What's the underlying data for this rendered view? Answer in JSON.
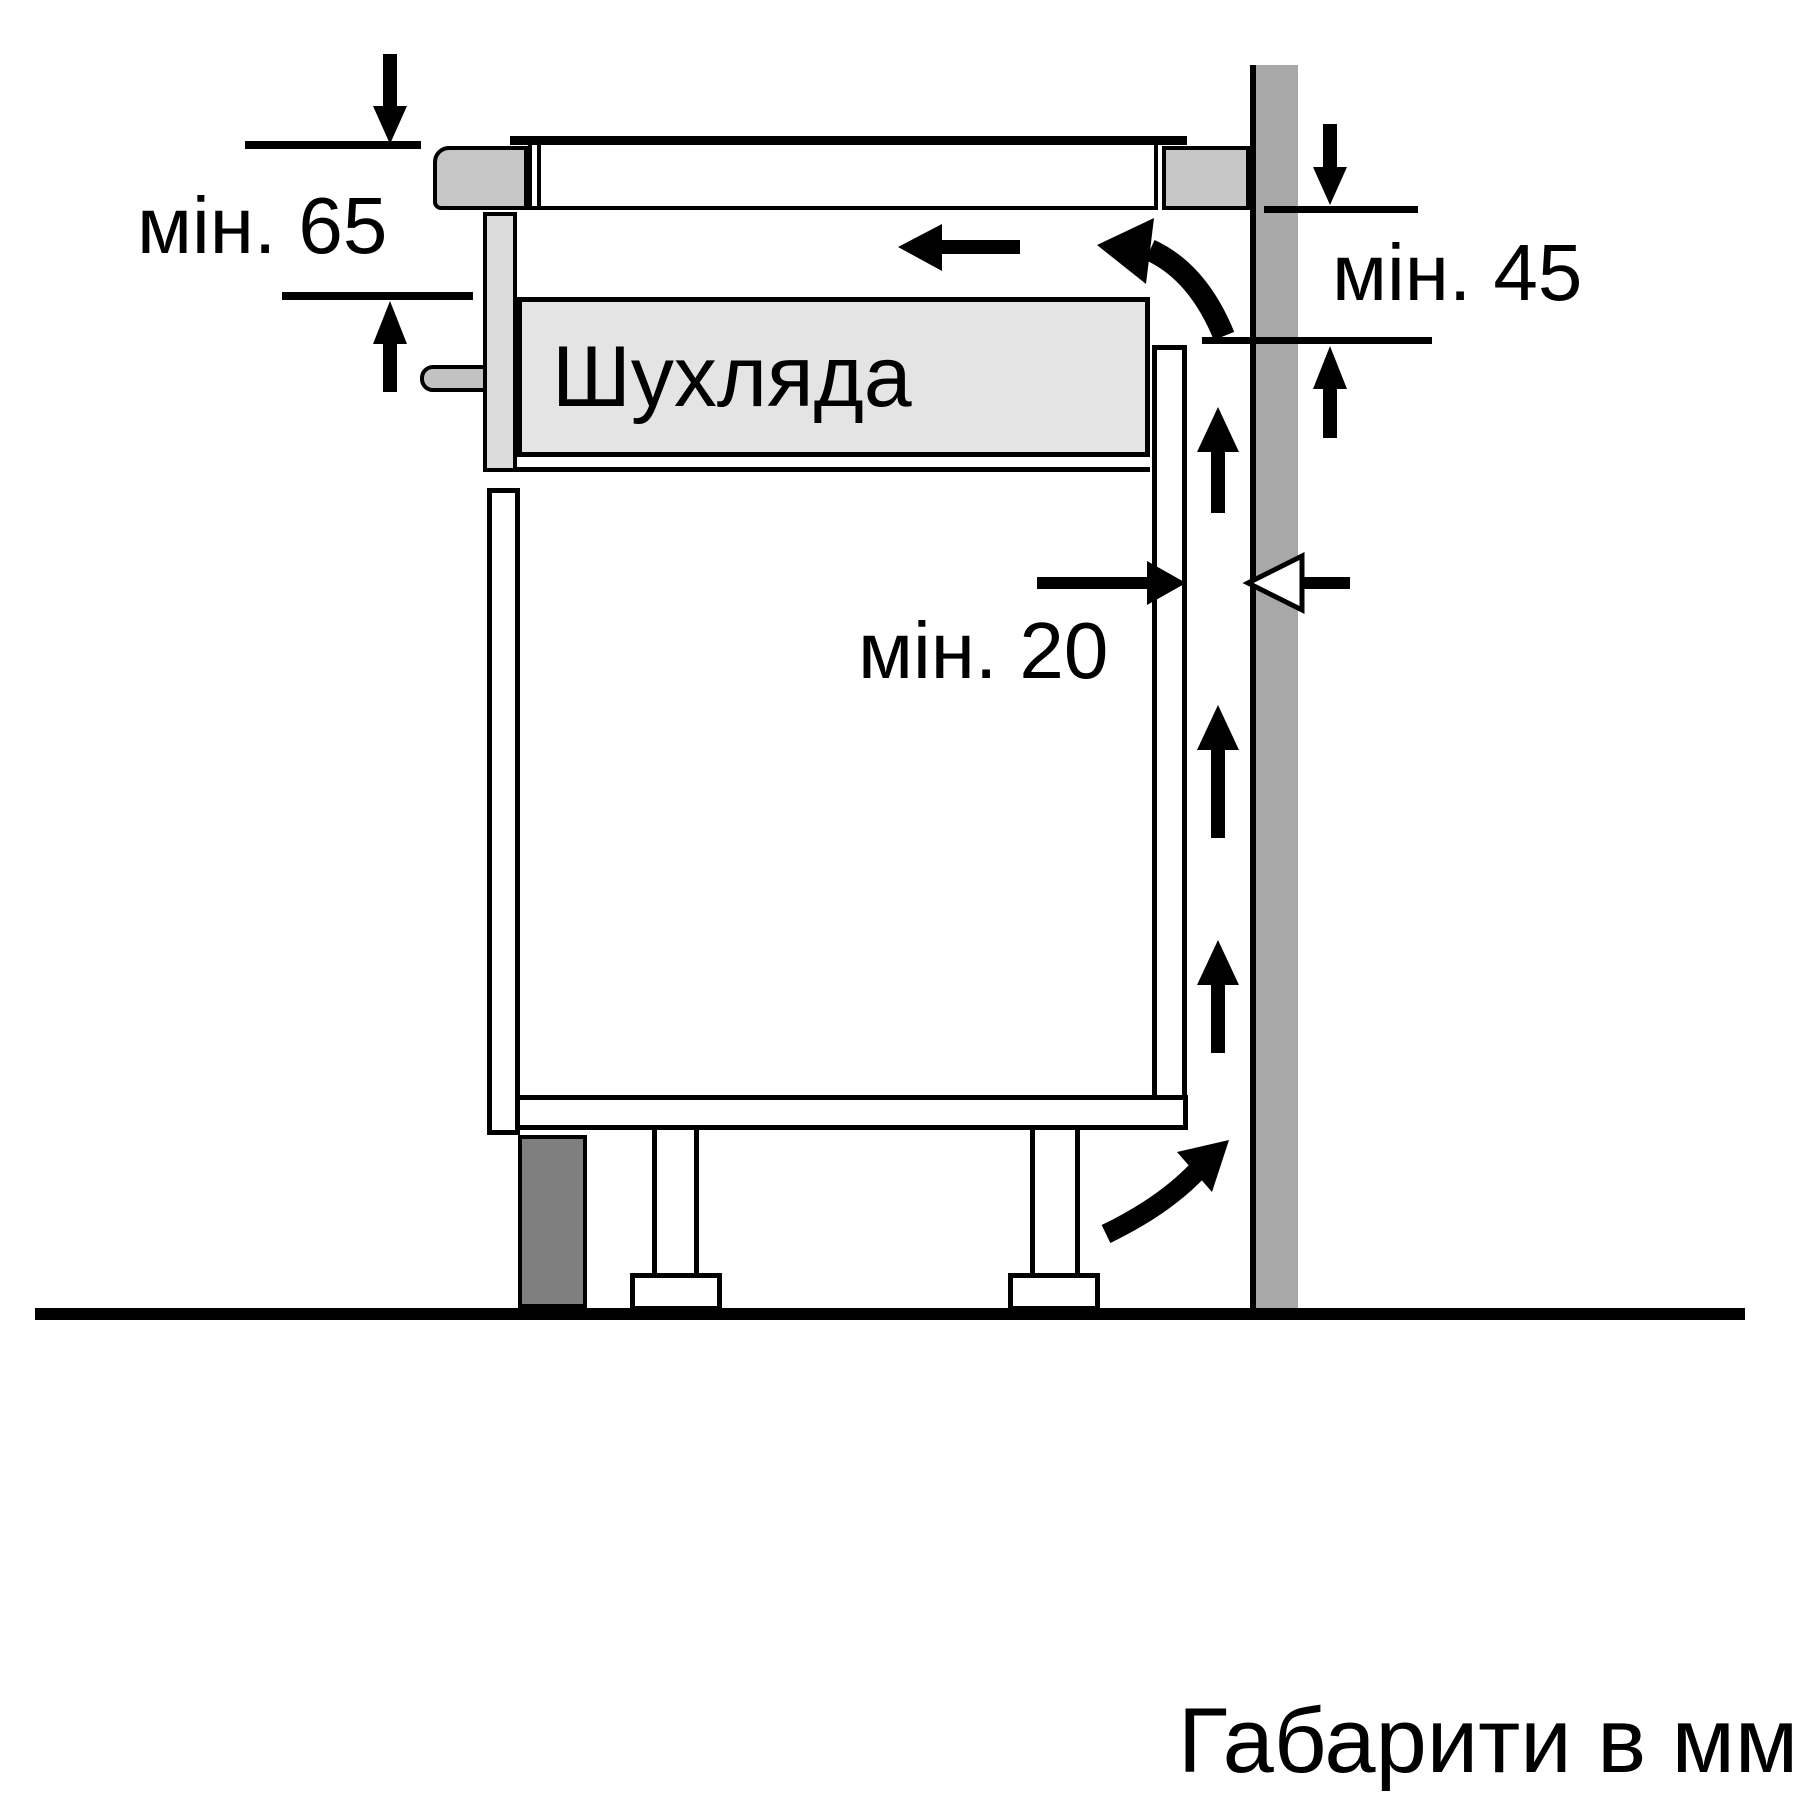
{
  "diagram": {
    "type": "appliance-installation-section",
    "drawer_label": "Шухляда",
    "units_note": "Габарити в мм",
    "dimensions": [
      {
        "id": "min-65",
        "label": "мін. 65",
        "value": 65,
        "unit": "мм",
        "meaning": "clearance below worktop at front"
      },
      {
        "id": "min-45",
        "label": "мін. 45",
        "value": 45,
        "unit": "мм",
        "meaning": "clearance behind worktop at wall"
      },
      {
        "id": "min-20",
        "label": "мін. 20",
        "value": 20,
        "unit": "мм",
        "meaning": "ventilation gap between cabinet back and wall"
      }
    ],
    "colors": {
      "wall": "#a8a8a8",
      "worktop": "#c6c6c6",
      "drawer": "#e4e4e4",
      "drawer_front": "#dcdcdc",
      "handle": "#c2c2c2",
      "plinth": "#7f7f7f",
      "line": "#000000",
      "background": "#ffffff"
    }
  }
}
